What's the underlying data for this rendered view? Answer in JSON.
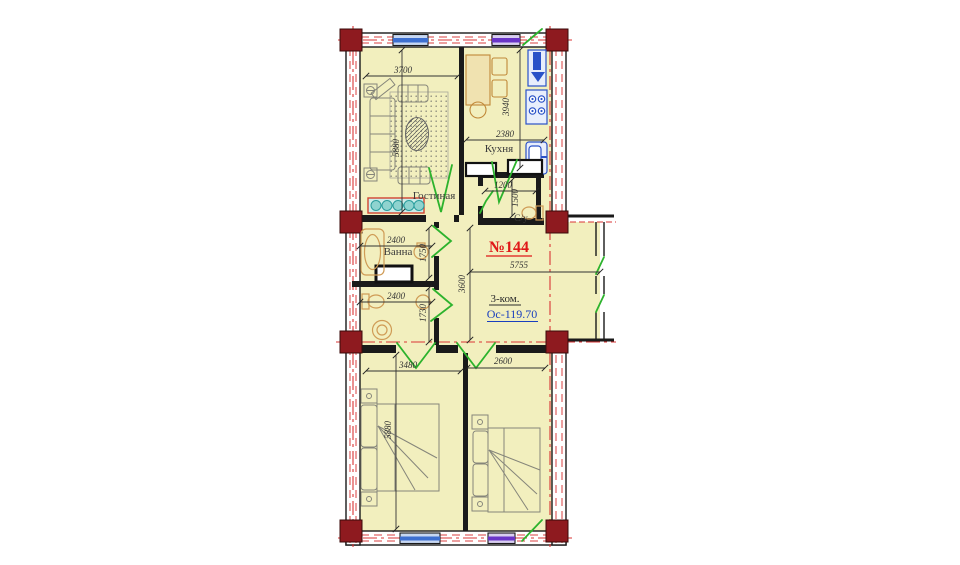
{
  "apartment": {
    "number": "№144",
    "type_label": "3-ком.",
    "area_label": "Ос-119.70"
  },
  "rooms": {
    "living": {
      "label": "Гостиная",
      "dim_w": "3700",
      "dim_h": "5880"
    },
    "kitchen": {
      "label": "Кухня",
      "dim_w": "2380",
      "dim_h": "3940"
    },
    "wc": {
      "label": "С/у",
      "dim_w": "1200",
      "dim_h": "1500"
    },
    "bath": {
      "label": "Ванна",
      "dim_w": "2400",
      "dim_h": "1750"
    },
    "toilet": {
      "dim_w": "2400",
      "dim_h": "1730"
    },
    "hall": {
      "dim_w": "5755",
      "dim_h": "3600"
    },
    "bedroom1": {
      "dim_w": "3480",
      "dim_h": "5880"
    },
    "bedroom2": {
      "dim_w": "2600"
    }
  },
  "colors": {
    "wall": "#1a1a1a",
    "room_fill": "#f2efbe",
    "axis_red": "#d93535",
    "door_green": "#2db32d",
    "column_red": "#8e1a1f",
    "window_blue": "#3d6fd0",
    "window_purple": "#6a35c8",
    "fixture_blue": "#2a52c8",
    "fixture_tan": "#cf9b55",
    "area_label_blue": "#1a3fbf",
    "number_red": "#e01818"
  }
}
